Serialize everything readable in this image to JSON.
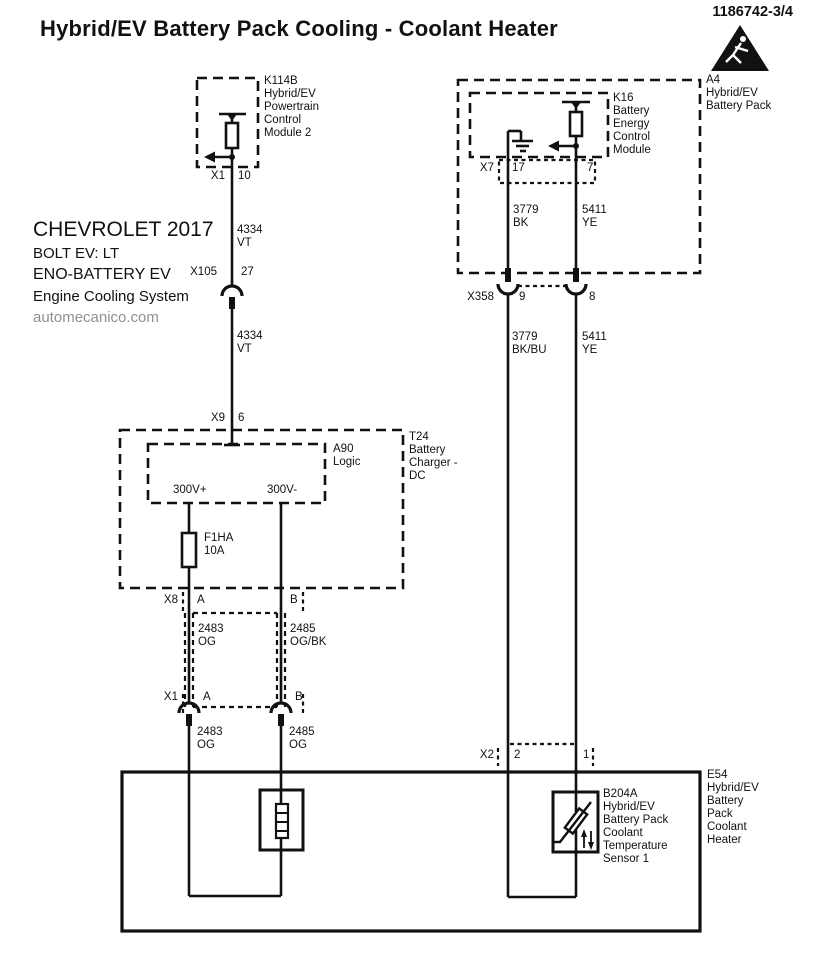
{
  "header": {
    "title": "Hybrid/EV Battery Pack Cooling - Coolant Heater",
    "doc_number": "1186742-3/4",
    "hazard_icon": "electric-shock-warning-triangle"
  },
  "vehicle_info": {
    "make_year": "CHEVROLET 2017",
    "model": "BOLT EV: LT",
    "system": "ENO-BATTERY EV",
    "subsystem": "Engine Cooling System",
    "source": "automecanico.com"
  },
  "colors": {
    "ink": "#111111",
    "muted_text": "#8f8f8f",
    "background": "#ffffff"
  },
  "components": {
    "k114b": {
      "label": "K114B\nHybrid/EV\nPowertrain\nControl\nModule 2"
    },
    "a4": {
      "label": "A4\nHybrid/EV\nBattery Pack"
    },
    "k16": {
      "label": "K16\nBattery\nEnergy\nControl\nModule"
    },
    "t24": {
      "label": "T24\nBattery\nCharger -\nDC"
    },
    "a90": {
      "label": "A90\nLogic"
    },
    "f1ha": {
      "label": "F1HA\n10A"
    },
    "b204a": {
      "label": "B204A\nHybrid/EV\nBattery Pack\nCoolant\nTemperature\nSensor 1"
    },
    "e54": {
      "label": "E54\nHybrid/EV\nBattery\nPack\nCoolant\nHeater"
    }
  },
  "terminals": {
    "p300": "300V+",
    "n300": "300V-"
  },
  "connectors": {
    "x1_top": {
      "name": "X1",
      "pin": "10"
    },
    "x105": {
      "name": "X105",
      "pin": "27"
    },
    "x9": {
      "name": "X9",
      "pin": "6"
    },
    "x8": {
      "name": "X8",
      "pin_a": "A",
      "pin_b": "B"
    },
    "x1_bot": {
      "name": "X1",
      "pin_a": "A",
      "pin_b": "B"
    },
    "x7": {
      "name": "X7",
      "pin_left": "17",
      "pin_right": "7"
    },
    "x358": {
      "name": "X358",
      "pin_left": "9",
      "pin_right": "8"
    },
    "x2": {
      "name": "X2",
      "pin_left": "2",
      "pin_right": "1"
    }
  },
  "wires": {
    "w4334_upper": "4334\nVT",
    "w4334_lower": "4334\nVT",
    "w2483_upper": "2483\nOG",
    "w2485_upper": "2485\nOG/BK",
    "w2483_lower": "2483\nOG",
    "w2485_lower": "2485\nOG",
    "w3779_upper": "3779\nBK",
    "w5411_upper": "5411\nYE",
    "w3779_lower": "3779\nBK/BU",
    "w5411_lower": "5411\nYE"
  }
}
